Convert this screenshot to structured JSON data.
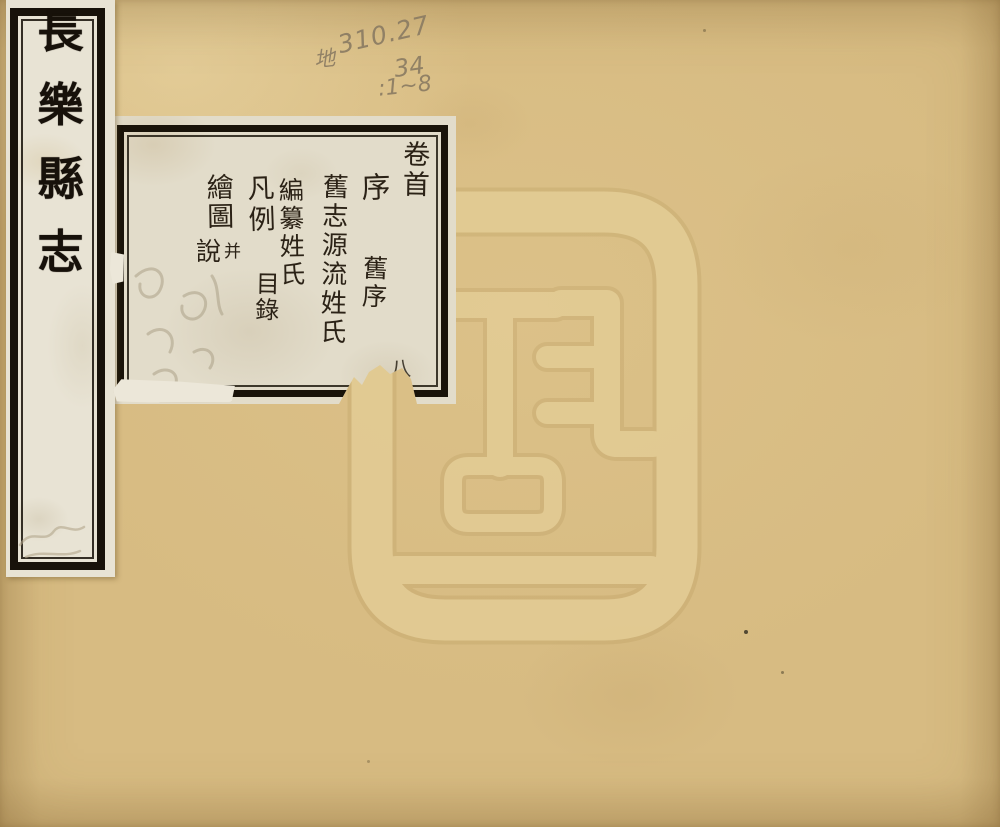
{
  "page": {
    "kind": "scanned-book-cover"
  },
  "title_strip": {
    "title": "長樂縣志",
    "chars": [
      "長",
      "樂",
      "縣",
      "志"
    ]
  },
  "call_number": {
    "prefix": "地",
    "line1": "310.27",
    "line2": "34",
    "line3": ":1~8"
  },
  "contents_label": {
    "reading_order": [
      "卷首",
      "序",
      "舊序",
      "舊志源流姓氏",
      "編纂姓氏",
      "凡例",
      "目錄",
      "繪圖并說",
      "八"
    ],
    "blocks": {
      "juanshou": "卷首",
      "xu": "序",
      "jiuxu": "舊序",
      "jiuzhi_yuanliu": "舊志源流姓氏",
      "bianzuan_xingshi": "編纂姓氏",
      "fanli": "凡例",
      "mulu": "目錄",
      "huitu": "繪圖",
      "bing": "并",
      "shuo": "說",
      "ba": "八"
    }
  },
  "watermark": {
    "icon": "library-seal-watermark"
  },
  "colors": {
    "cover": "#d7bb82",
    "strip_paper": "#e8e3d4",
    "label_paper": "#e2dcca",
    "ink": "#1c150c",
    "pencil": "#8b7c63",
    "watermark_light": "#e4cd97",
    "watermark_dark": "#b69a5e"
  }
}
